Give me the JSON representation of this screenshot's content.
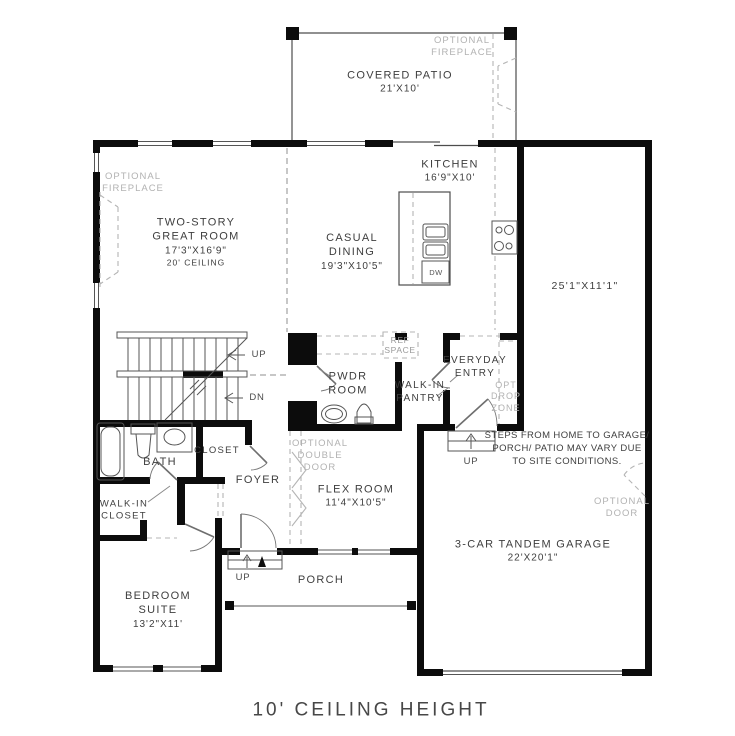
{
  "title": "10' CEILING HEIGHT",
  "colors": {
    "wall": "#0c0c0c",
    "line": "#4d4d4d",
    "optional_gray": "#b2b2b2",
    "text": "#3e3e3e"
  },
  "rooms": {
    "covered_patio": {
      "name": "COVERED PATIO",
      "dims": "21'X10'"
    },
    "kitchen": {
      "name": "KITCHEN",
      "dims": "16'9\"X10'"
    },
    "casual_dining": {
      "line1": "CASUAL",
      "line2": "DINING",
      "dims": "19'3\"X10'5\""
    },
    "great_room": {
      "line1": "TWO-STORY",
      "line2": "GREAT ROOM",
      "dims": "17'3\"X16'9\"",
      "note": "20' CEILING"
    },
    "right_wing": {
      "dims": "25'1\"X11'1\""
    },
    "pwdr_room": {
      "line1": "PWDR",
      "line2": "ROOM"
    },
    "walk_in_pantry": {
      "line1": "WALK-IN",
      "line2": "PANTRY"
    },
    "everyday_entry": {
      "line1": "EVERYDAY",
      "line2": "ENTRY"
    },
    "bath": {
      "name": "BATH"
    },
    "closet": {
      "name": "CLOSET"
    },
    "foyer": {
      "name": "FOYER"
    },
    "flex_room": {
      "name": "FLEX ROOM",
      "dims": "11'4\"X10'5\""
    },
    "walk_in_closet": {
      "line1": "WALK-IN",
      "line2": "CLOSET"
    },
    "bedroom_suite": {
      "line1": "BEDROOM",
      "line2": "SUITE",
      "dims": "13'2\"X11'"
    },
    "garage": {
      "name": "3-CAR TANDEM GARAGE",
      "dims": "22'X20'1\""
    },
    "porch": {
      "name": "PORCH"
    }
  },
  "annotations": {
    "optional_fireplace_left": {
      "line1": "OPTIONAL",
      "line2": "FIREPLACE"
    },
    "optional_fireplace_top": {
      "line1": "OPTIONAL",
      "line2": "FIREPLACE"
    },
    "ref_space": {
      "line1": "REF",
      "line2": "SPACE"
    },
    "opt_drop_zone": {
      "line1": "OPT",
      "line2": "DROP",
      "line3": "ZONE"
    },
    "optional_double_door": {
      "line1": "OPTIONAL",
      "line2": "DOUBLE",
      "line3": "DOOR"
    },
    "optional_door": {
      "line1": "OPTIONAL",
      "line2": "DOOR"
    },
    "steps_note": {
      "line1": "STEPS FROM HOME TO GARAGE/",
      "line2": "PORCH/ PATIO MAY VARY DUE",
      "line3": "TO SITE CONDITIONS."
    },
    "up_stairs": "UP",
    "dn_stairs": "DN",
    "up_garage": "UP",
    "up_porch": "UP",
    "dishwasher": "DW"
  }
}
